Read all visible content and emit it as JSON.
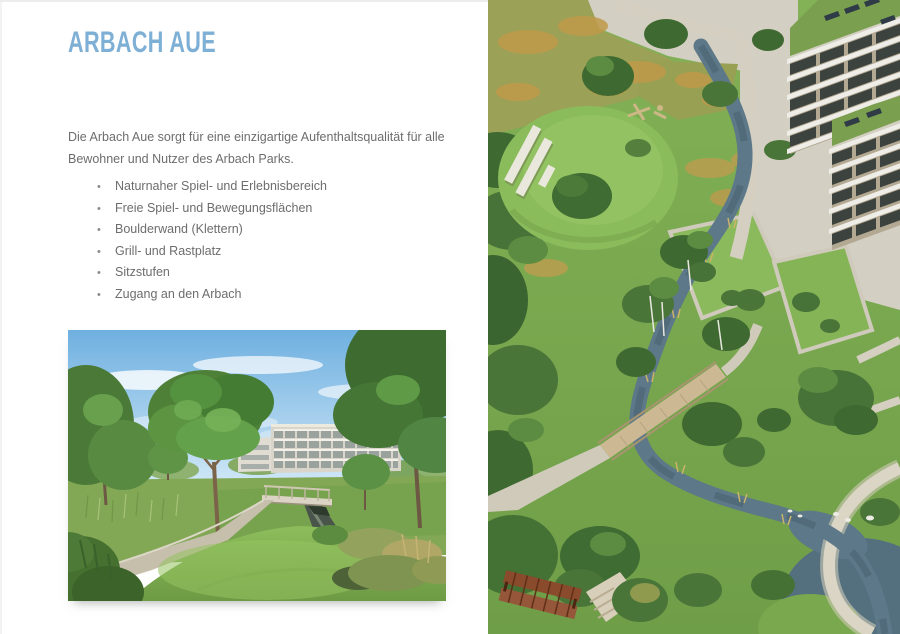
{
  "page": {
    "title": "ARBACH AUE",
    "intro": "Die Arbach Aue sorgt für eine einzigartige Aufenthaltsqualität für alle Bewohner und Nutzer des Arbach Parks.",
    "bullet_glyph": "•",
    "features": [
      "Naturnaher Spiel- und Erlebnisbereich",
      "Freie Spiel- und Bewegungsflächen",
      "Boulderwand (Klettern)",
      "Grill- und Rastplatz",
      "Sitzstufen",
      "Zugang an den Arbach"
    ],
    "colors": {
      "title_blue": "#7eb0d6",
      "body_gray": "#6d6d6d",
      "page_background": "#ffffff"
    },
    "images": {
      "ground_view_alt": "Rendering: Weg und Steg über den Arbach im Park",
      "aerial_view_alt": "Rendering: Luftbild der Arbach Aue mit Bachlauf, Holzbrücke, Spielhügel und Wohngebäuden"
    }
  }
}
